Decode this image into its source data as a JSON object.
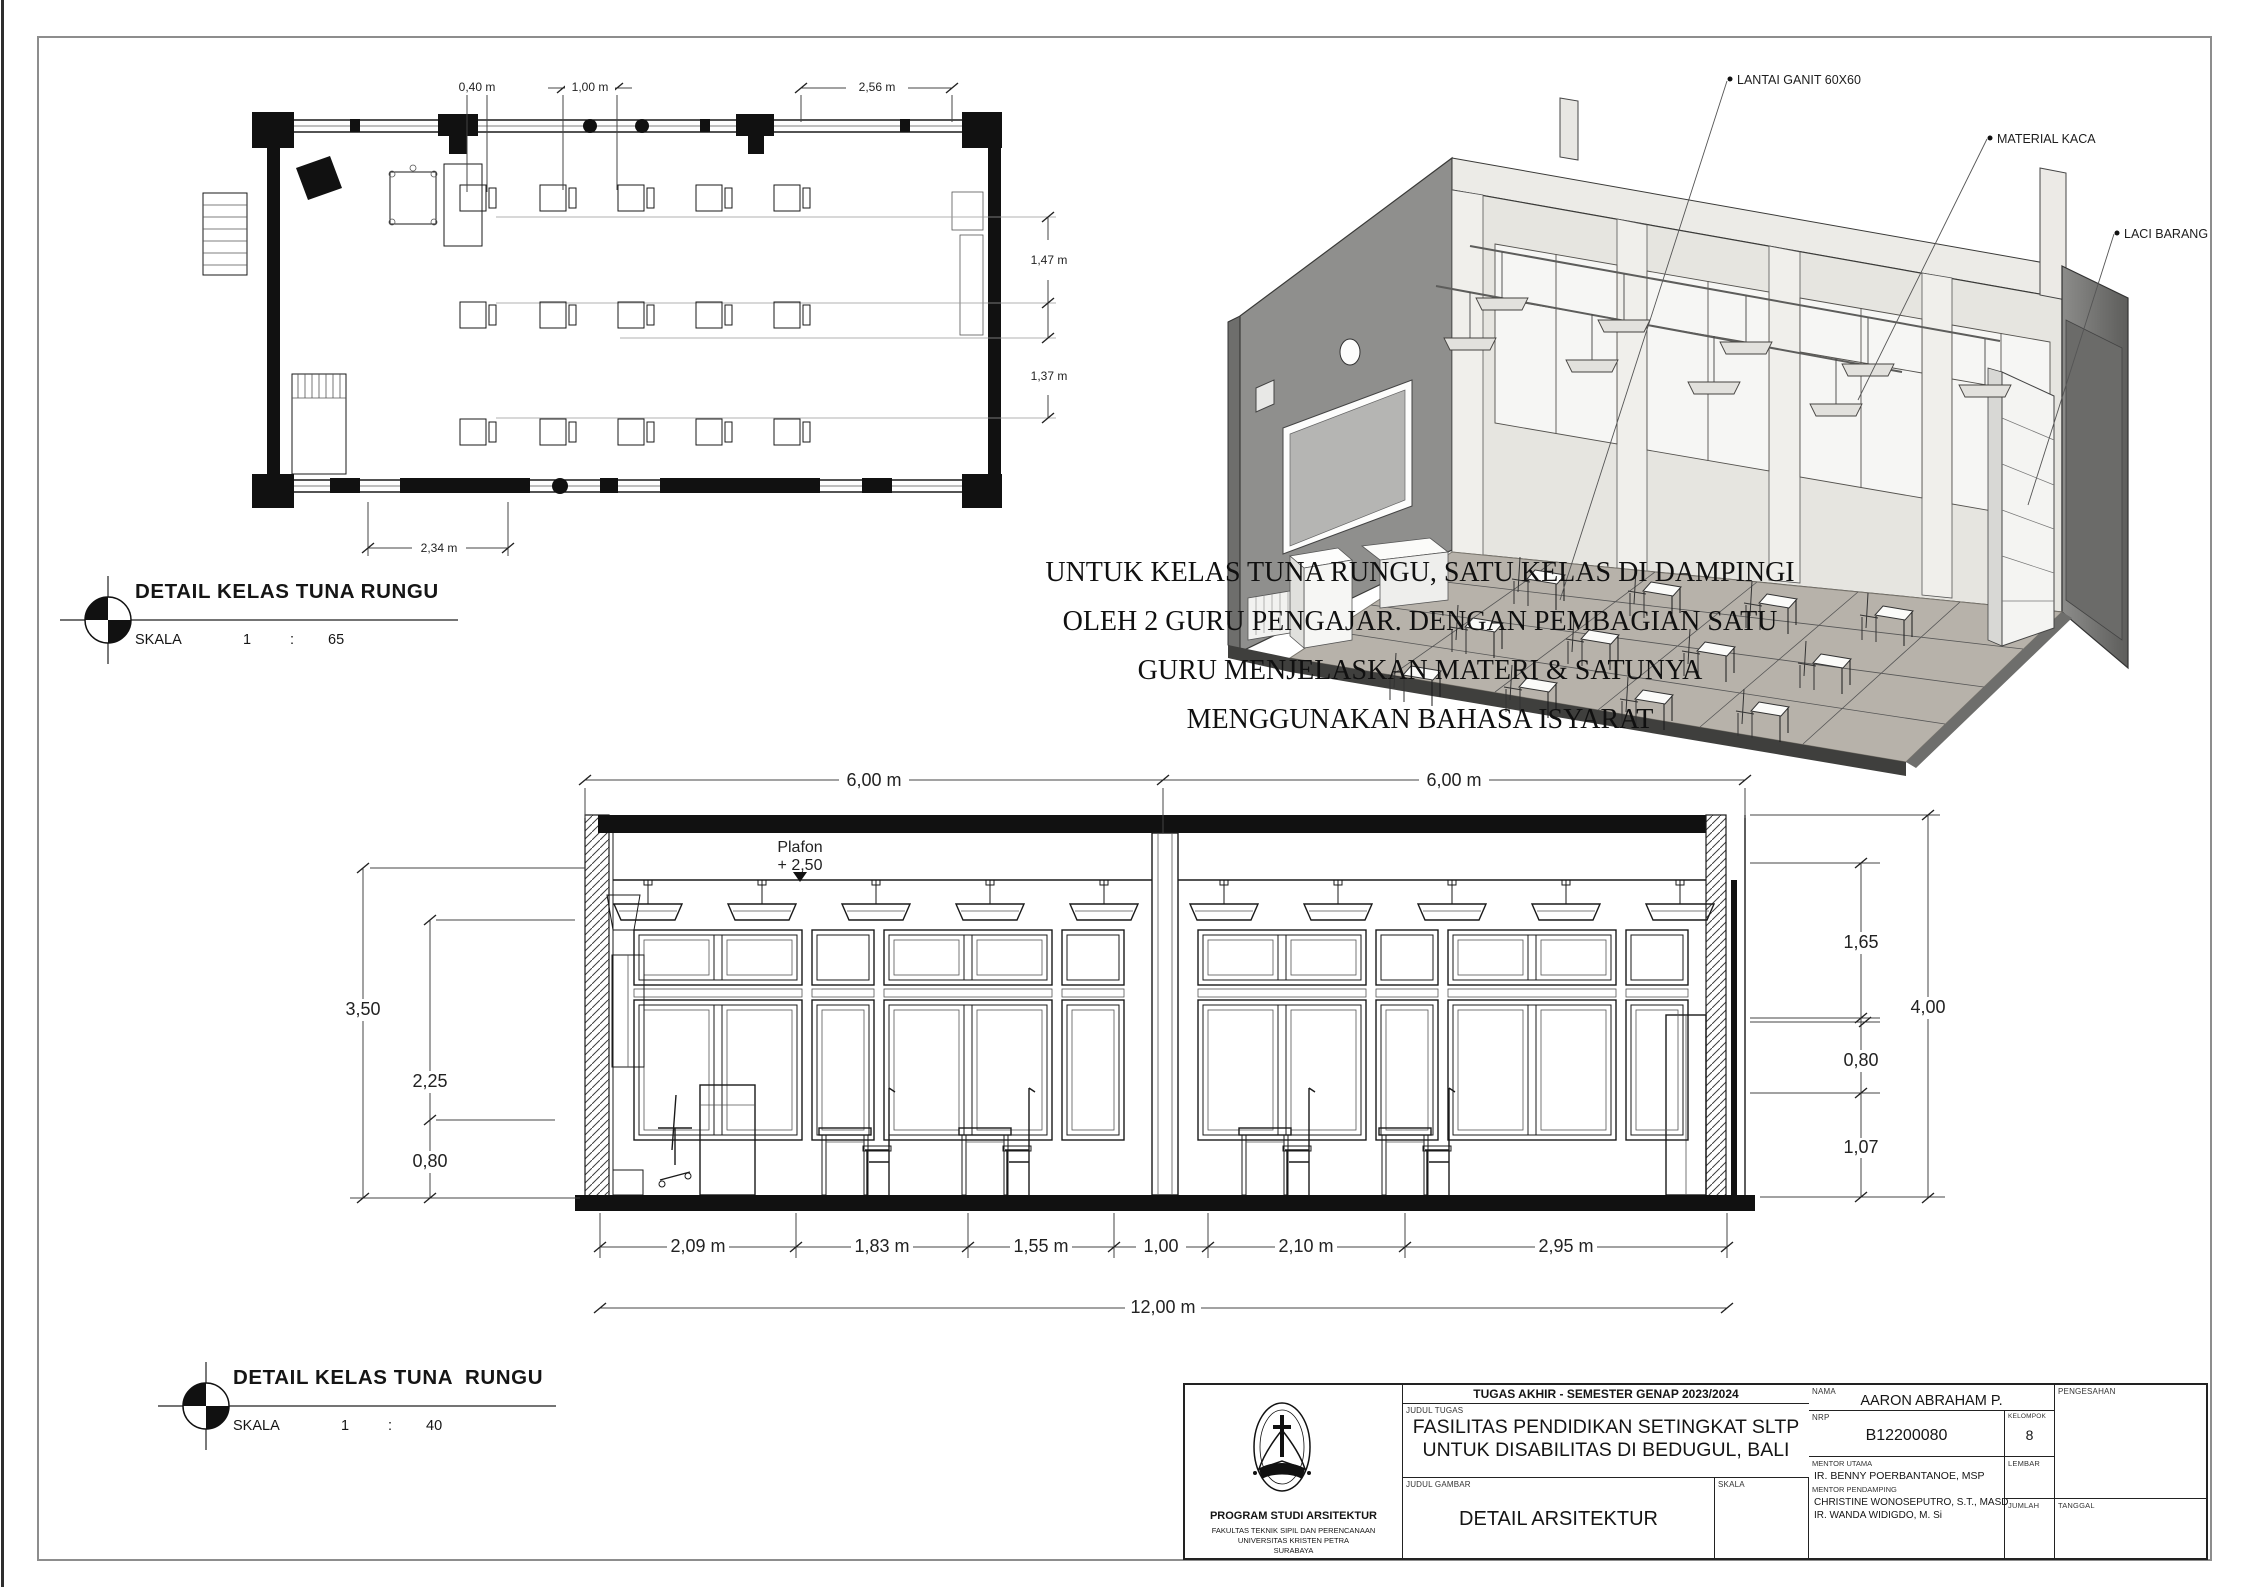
{
  "plan_detail": {
    "title": "DETAIL KELAS TUNA RUNGU",
    "scale": {
      "label": "SKALA",
      "numerator": "1",
      "separator": ":",
      "value": "65"
    },
    "dimensions": {
      "desk_width": "0,40 m",
      "aisle": "1,00 m",
      "front_zone": "2,56 m",
      "row_gap_upper": "1,47 m",
      "row_gap_lower": "1,37 m",
      "back_zone": "2,34 m"
    }
  },
  "axon_view": {
    "callouts": {
      "floor": "LANTAI GANIT 60X60",
      "glass": "MATERIAL KACA",
      "drawer": "LACI BARANG"
    }
  },
  "note": {
    "line1": "UNTUK KELAS TUNA RUNGU, SATU KELAS DI DAMPINGI",
    "line2": "OLEH 2 GURU PENGAJAR. DENGAN PEMBAGIAN SATU",
    "line3": "GURU MENJELASKAN MATERI & SATUNYA",
    "line4": "MENGGUNAKAN BAHASA ISYARAT"
  },
  "section_detail": {
    "title": "DETAIL KELAS TUNA  RUNGU",
    "scale": {
      "label": "SKALA",
      "numerator": "1",
      "separator": ":",
      "value": "40"
    },
    "annotations": {
      "ceiling_label": "Plafon",
      "ceiling_level": "+ 2,50"
    },
    "dimensions": {
      "span_left": "6,00 m",
      "span_right": "6,00 m",
      "height_left_total": "3,50",
      "height_left_upper": "2,25",
      "height_left_lower": "0,80",
      "height_right_upper": "1,65",
      "height_right_mid": "0,80",
      "height_right_lower": "1,07",
      "height_right_total": "4,00",
      "seg_1": "2,09 m",
      "seg_2": "1,83 m",
      "seg_3": "1,55 m",
      "seg_4": "1,00",
      "seg_5": "2,10 m",
      "seg_6": "2,95 m",
      "total": "12,00 m"
    }
  },
  "title_block": {
    "header": "TUGAS AKHIR - SEMESTER GENAP 2023/2024",
    "labels": {
      "judul_tugas": "JUDUL TUGAS",
      "judul_gambar": "JUDUL GAMBAR",
      "skala": "SKALA",
      "nama": "NAMA",
      "nrp": "NRP",
      "kelompok": "KELOMPOK",
      "pengesahan": "PENGESAHAN",
      "mentor_utama": "MENTOR UTAMA",
      "mentor_pendamping": "MENTOR PENDAMPING",
      "lembar": "LEMBAR",
      "jumlah": "JUMLAH",
      "tanggal": "TANGGAL"
    },
    "values": {
      "judul_tugas_line1": "FASILITAS PENDIDIKAN SETINGKAT SLTP",
      "judul_tugas_line2": "UNTUK DISABILITAS DI BEDUGUL, BALI",
      "judul_gambar": "DETAIL ARSITEKTUR",
      "nama": "AARON ABRAHAM P.",
      "nrp": "B12200080",
      "kelompok": "8",
      "mentor_utama": "IR. BENNY POERBANTANOE, MSP",
      "mentor_pendamping_1": "CHRISTINE WONOSEPUTRO, S.T., MASD",
      "mentor_pendamping_2": "IR. WANDA WIDIGDO, M. Si"
    },
    "institution": {
      "program": "PROGRAM STUDI ARSITEKTUR",
      "faculty": "FAKULTAS TEKNIK SIPIL DAN PERENCANAAN",
      "university": "UNIVERSITAS KRISTEN PETRA",
      "city": "SURABAYA"
    }
  }
}
